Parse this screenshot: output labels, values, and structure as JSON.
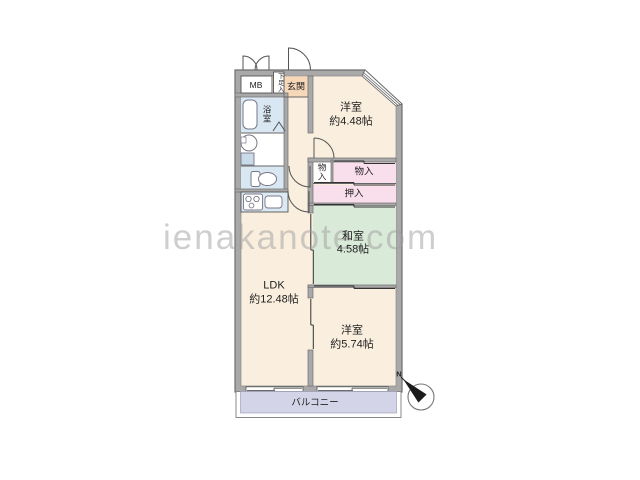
{
  "watermark": "ienakanote.com",
  "compass": {
    "north_label": "N"
  },
  "colors": {
    "wall": "#a9a9a9",
    "wall_edge": "#6e6e6e",
    "floor_cream": "#faefdf",
    "entrance_peach": "#f6d7b8",
    "wet_area_blue": "#d9e7f2",
    "tatami_green": "#d9ead9",
    "closet_pink": "#f9dfeb",
    "balcony_lavender": "#d4d4e8"
  },
  "rooms": {
    "meter_box": {
      "name": "MB"
    },
    "shoe_box": {
      "name": "下足入"
    },
    "entrance": {
      "name": "玄関"
    },
    "bathroom": {
      "name": "浴室"
    },
    "western_room_top": {
      "name": "洋室",
      "size": "約4.48帖"
    },
    "storage_small": {
      "name": "物入"
    },
    "storage_wide": {
      "name": "物入"
    },
    "closet": {
      "name": "押入"
    },
    "japanese_room": {
      "name": "和室",
      "size": "4.58帖"
    },
    "ldk": {
      "name": "LDK",
      "size": "約12.48帖"
    },
    "western_room_bottom": {
      "name": "洋室",
      "size": "約5.74帖"
    },
    "balcony": {
      "name": "バルコニー"
    }
  }
}
